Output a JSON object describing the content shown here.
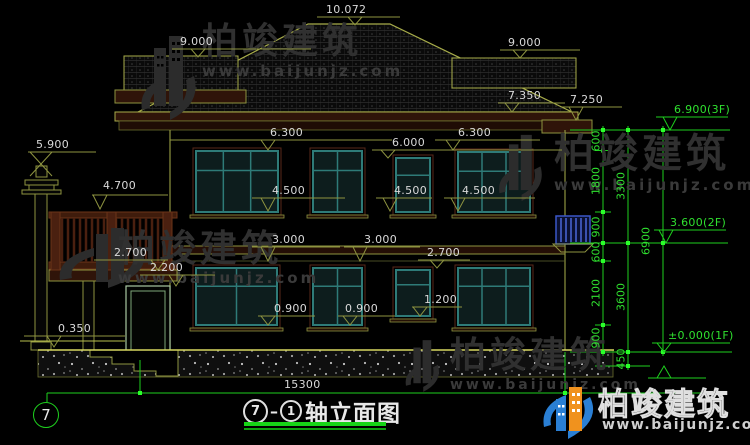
{
  "drawing_title": {
    "circle_a": "7",
    "circle_b": "1",
    "label": "轴立面图"
  },
  "axis_bubble_label": "7",
  "bottom_dimension": "15300",
  "brand": {
    "name": "柏竣建筑",
    "url": "www.baijunjz.com"
  },
  "colors": {
    "cad_line": "#8e9440",
    "cad_green": "#1ecf1e",
    "dim_text": "#d9d9d9",
    "green_text": "#2fe02f",
    "window_teal": "#2e7b78",
    "trim_maroon": "#58281a",
    "logo_blue": "#2a7fd4",
    "logo_orange": "#f0921e"
  },
  "elevation_markers": [
    {
      "t": "10.072",
      "x": 326,
      "y": 4,
      "l": [
        317,
        400,
        17
      ],
      "tri": [
        355,
        25
      ],
      "c": "w"
    },
    {
      "t": "9.000",
      "x": 180,
      "y": 36,
      "l": [
        172,
        311,
        49
      ],
      "tri": [
        198,
        57
      ],
      "c": "w"
    },
    {
      "t": "9.000",
      "x": 508,
      "y": 37,
      "l": [
        500,
        580,
        50
      ],
      "tri": [
        520,
        58
      ],
      "c": "w"
    },
    {
      "t": "7.350",
      "x": 508,
      "y": 90,
      "l": [
        498,
        565,
        103
      ],
      "tri": [
        512,
        112
      ],
      "c": "w"
    },
    {
      "t": "7.250",
      "x": 570,
      "y": 94,
      "l": [
        562,
        622,
        107
      ],
      "tri": [
        576,
        120
      ],
      "c": "w"
    },
    {
      "t": "6.300",
      "x": 270,
      "y": 127,
      "l": [
        170,
        392,
        140
      ],
      "tri": [
        268,
        150
      ],
      "c": "w"
    },
    {
      "t": "6.300",
      "x": 458,
      "y": 127,
      "l": [
        435,
        540,
        140
      ],
      "tri": [
        453,
        150
      ],
      "c": "w"
    },
    {
      "t": "6.000",
      "x": 392,
      "y": 137,
      "l": [
        372,
        562,
        150
      ],
      "tri": [
        388,
        158
      ],
      "c": "w"
    },
    {
      "t": "4.500",
      "x": 272,
      "y": 185,
      "l": [
        252,
        345,
        198
      ],
      "tri": [
        268,
        211
      ],
      "c": "w"
    },
    {
      "t": "4.500",
      "x": 394,
      "y": 185,
      "l": [
        376,
        432,
        198
      ],
      "tri": [
        390,
        211
      ],
      "c": "w"
    },
    {
      "t": "4.500",
      "x": 462,
      "y": 185,
      "l": [
        444,
        535,
        198
      ],
      "tri": [
        458,
        211
      ],
      "c": "w"
    },
    {
      "t": "5.900",
      "x": 36,
      "y": 139,
      "l": [
        28,
        96,
        152
      ],
      "tri": [
        41,
        176
      ],
      "c": "w",
      "type": "x"
    },
    {
      "t": "4.700",
      "x": 103,
      "y": 180,
      "l": [
        92,
        168,
        195
      ],
      "tri": [
        100,
        209
      ],
      "c": "w"
    },
    {
      "t": "3.000",
      "x": 272,
      "y": 234,
      "l": [
        252,
        340,
        247
      ],
      "tri": [
        268,
        261
      ],
      "c": "w"
    },
    {
      "t": "3.000",
      "x": 364,
      "y": 234,
      "l": [
        344,
        420,
        247
      ],
      "tri": [
        360,
        261
      ],
      "c": "w"
    },
    {
      "t": "2.700",
      "x": 114,
      "y": 247,
      "l": [
        94,
        168,
        260
      ],
      "tri": [
        158,
        270
      ],
      "c": "w"
    },
    {
      "t": "2.200",
      "x": 150,
      "y": 262,
      "l": [
        140,
        215,
        275
      ],
      "tri": [
        176,
        286
      ],
      "c": "w"
    },
    {
      "t": "2.700",
      "x": 427,
      "y": 247,
      "l": [
        418,
        470,
        260
      ],
      "tri": [
        437,
        268
      ],
      "c": "w"
    },
    {
      "t": "1.200",
      "x": 424,
      "y": 294,
      "l": [
        412,
        462,
        307
      ],
      "tri": [
        420,
        316
      ],
      "c": "w"
    },
    {
      "t": "0.900",
      "x": 274,
      "y": 303,
      "l": [
        258,
        315,
        316
      ],
      "tri": [
        268,
        325
      ],
      "c": "w"
    },
    {
      "t": "0.900",
      "x": 345,
      "y": 303,
      "l": [
        338,
        395,
        316
      ],
      "tri": [
        350,
        325
      ],
      "c": "w"
    },
    {
      "t": "0.350",
      "x": 58,
      "y": 323,
      "l": [
        24,
        125,
        336
      ],
      "tri": [
        54,
        347
      ],
      "c": "w"
    },
    {
      "t": "6.900(3F)",
      "x": 674,
      "y": 104,
      "l": [
        656,
        728,
        117
      ],
      "tri": [
        670,
        130
      ],
      "c": "g"
    },
    {
      "t": "3.600(2F)",
      "x": 670,
      "y": 217,
      "l": [
        654,
        726,
        230
      ],
      "tri": [
        666,
        243
      ],
      "c": "g"
    },
    {
      "t": "±0.000(1F)",
      "x": 668,
      "y": 330,
      "l": [
        652,
        730,
        343
      ],
      "tri": [
        664,
        352
      ],
      "c": "g"
    },
    {
      "t": "",
      "x": 700,
      "y": 370,
      "l": [
        648,
        706,
        378
      ],
      "tri": [
        664,
        366
      ],
      "c": "g",
      "type": "up"
    }
  ],
  "dimension_chains": [
    {
      "t": "600",
      "x": 596,
      "y": 141
    },
    {
      "t": "1800",
      "x": 596,
      "y": 181
    },
    {
      "t": "900",
      "x": 596,
      "y": 227
    },
    {
      "t": "600",
      "x": 596,
      "y": 252
    },
    {
      "t": "2100",
      "x": 596,
      "y": 293
    },
    {
      "t": "900",
      "x": 596,
      "y": 338
    },
    {
      "t": "3300",
      "x": 621,
      "y": 186
    },
    {
      "t": "3600",
      "x": 621,
      "y": 297
    },
    {
      "t": "450",
      "x": 621,
      "y": 359
    },
    {
      "t": "6900",
      "x": 646,
      "y": 241
    }
  ]
}
